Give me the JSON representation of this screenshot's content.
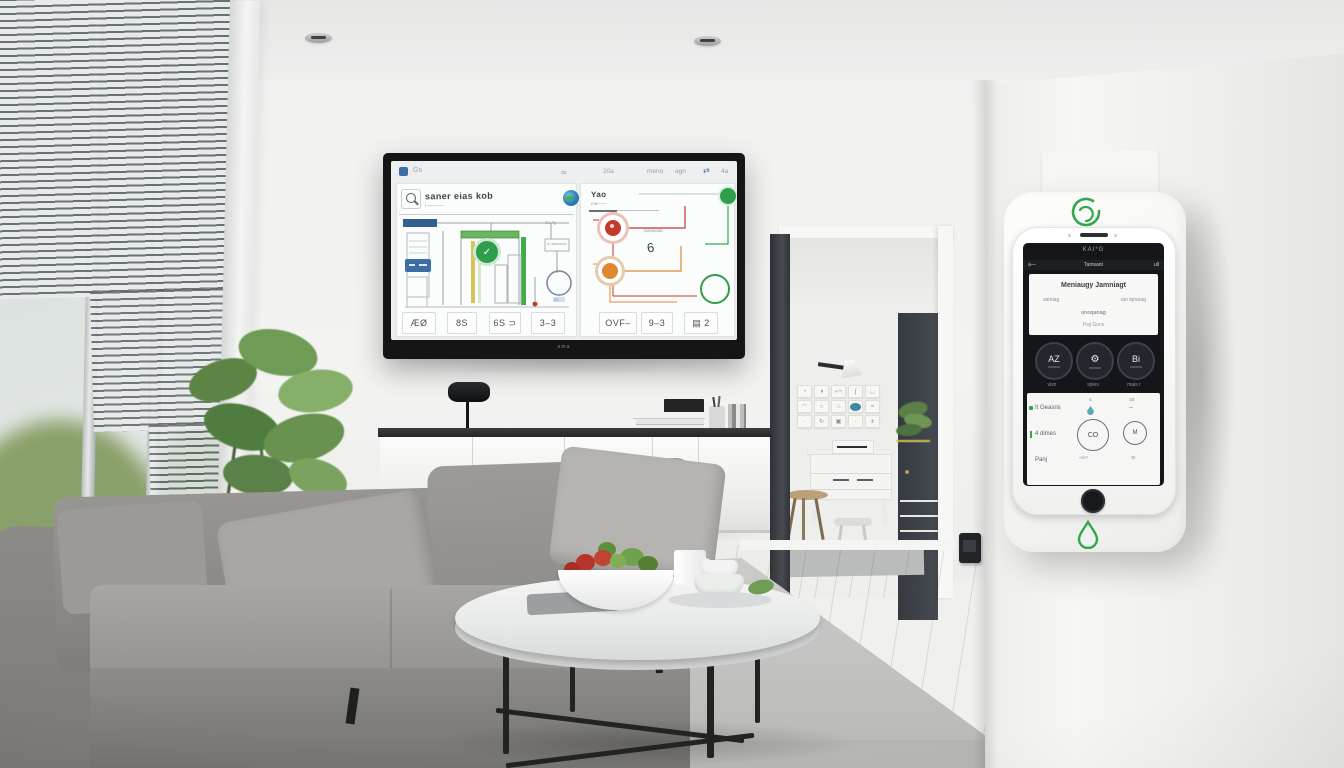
{
  "colors": {
    "accent_green": "#2fa84f",
    "alert_red": "#c23b2c",
    "alert_orange": "#e0872f",
    "info_blue": "#3a6ea5",
    "teal": "#3f88a0",
    "tv_screen_bg": "#edeff1",
    "device_screen_bg": "#141619"
  },
  "tv": {
    "brand": "ema",
    "top_bar": {
      "left_app": "Gs",
      "center": "da",
      "item1": "20a",
      "item2": "meno",
      "item3": "agn",
      "value": "4a"
    },
    "left_panel": {
      "title": "saner eias kob",
      "subtitle": "i ——·—",
      "note": "3a 4g",
      "pipe_label": "a.nasemas",
      "badge_glyph": "✓",
      "tag": "a1"
    },
    "right_panel": {
      "title": "Yao",
      "subtitle": "ma——",
      "note": "falviaisab",
      "glyph": "6"
    },
    "cards": [
      {
        "label": "ÆØ"
      },
      {
        "label": "8S"
      },
      {
        "label": "6S ⊃"
      },
      {
        "label": "3–3"
      },
      {
        "label": "OVF–"
      },
      {
        "label": "9–3"
      },
      {
        "label": "▤ 2"
      }
    ]
  },
  "device": {
    "brand": "KAI*G",
    "status_bar": {
      "left": "a—",
      "center": "Tamsant",
      "right": "ull"
    },
    "info_card": {
      "line1": "Meniaugy  Jamniagt",
      "line2_left": "samiag",
      "line2_right": "ran iqnarag",
      "line3": "unoqanag",
      "line4": "Paij Guns"
    },
    "tiles": [
      {
        "glyph": "AZ",
        "label": "visn"
      },
      {
        "glyph": "⚙",
        "label": "spies"
      },
      {
        "glyph": "Bi",
        "label": "mais r"
      }
    ],
    "panel": {
      "left_rows": [
        "It Geasns",
        "4 dimes",
        "Panj"
      ],
      "center": {
        "top": "a",
        "gauge": "CO",
        "bottom": "‹on?"
      },
      "right": {
        "top": "1B",
        "gauge": "M",
        "bottom": "W"
      }
    }
  },
  "gallery": {
    "tiles": [
      {
        "glyph": "◔"
      },
      {
        "glyph": "◑"
      },
      {
        "glyph": "⌐¬"
      },
      {
        "glyph": "ʃ"
      },
      {
        "glyph": "◡"
      },
      {
        "glyph": "◠"
      },
      {
        "glyph": "○"
      },
      {
        "glyph": "∴"
      },
      {
        "glyph": ""
      },
      {
        "glyph": "≈"
      },
      {
        "glyph": "·"
      },
      {
        "glyph": "↻"
      },
      {
        "glyph": "▣"
      },
      {
        "glyph": "·"
      },
      {
        "glyph": "±"
      }
    ]
  }
}
